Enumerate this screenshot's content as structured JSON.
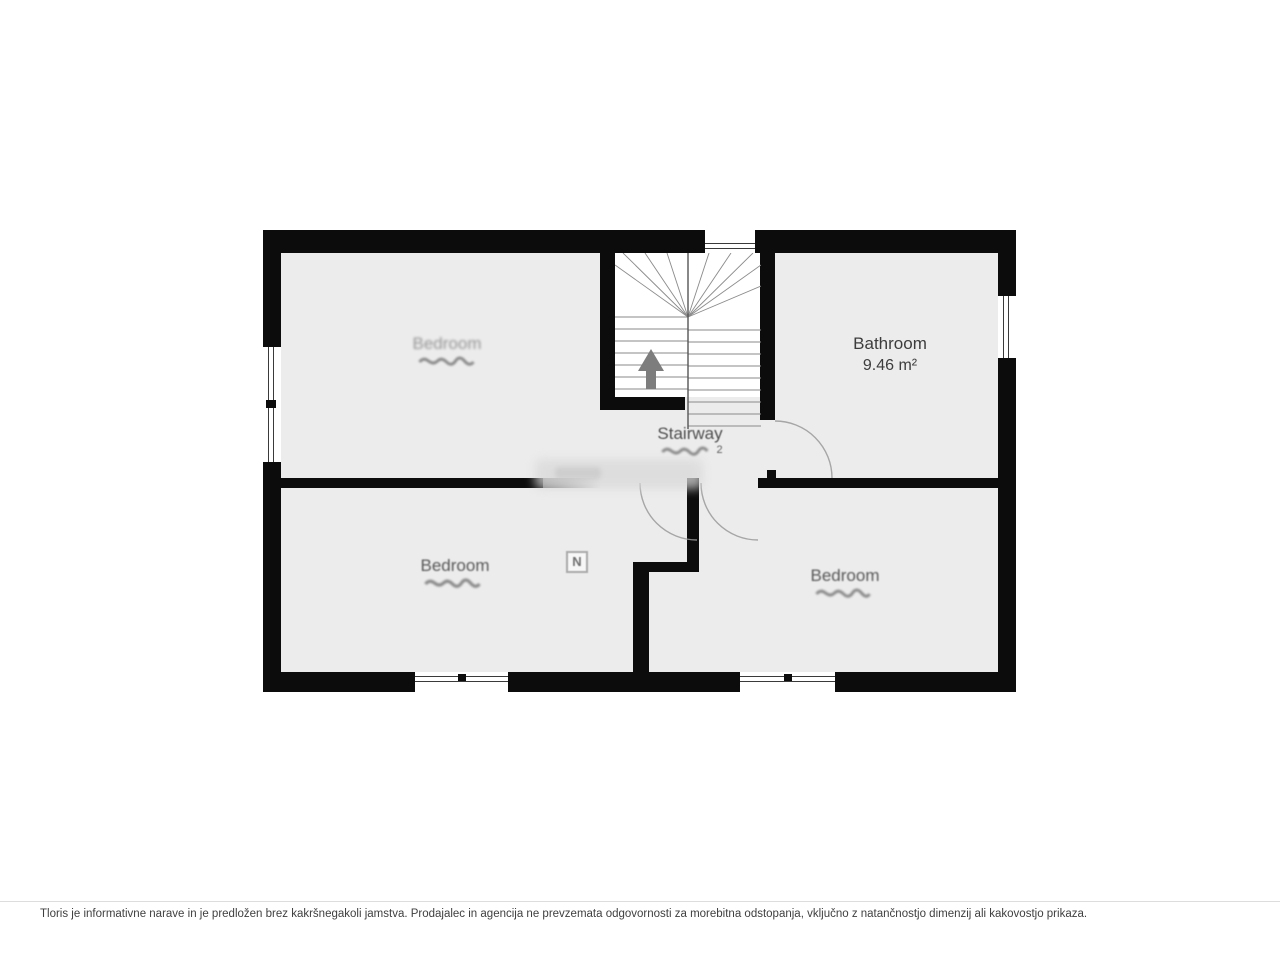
{
  "plan": {
    "compass_label": "N",
    "rooms": [
      {
        "id": "bedroom-top-left",
        "name": "Bedroom",
        "area": "",
        "legible": false
      },
      {
        "id": "stairway",
        "name": "Stairway",
        "area": "",
        "area_fragment": "2",
        "legible": true
      },
      {
        "id": "bathroom",
        "name": "Bathroom",
        "area": "9.46 m²",
        "legible": true
      },
      {
        "id": "bedroom-bottom-left",
        "name": "Bedroom",
        "area": "",
        "legible": true
      },
      {
        "id": "bedroom-bottom-right",
        "name": "Bedroom",
        "area": "",
        "legible": true
      }
    ]
  },
  "footer": {
    "disclaimer": "Tloris je informativne narave in je predložen brez kakršnegakoli jamstva. Prodajalec in agencija ne prevzemata odgovornosti za morebitna odstopanja, vključno z natančnostjo dimenzij ali kakovostjo prikaza."
  },
  "colors": {
    "wall": "#0c0c0c",
    "floor": "#ececec",
    "stair_area": "#ffffff",
    "label_text": "#3d3d3d",
    "arrow": "#7d7d7d",
    "door_arc": "#9a9a9a"
  }
}
